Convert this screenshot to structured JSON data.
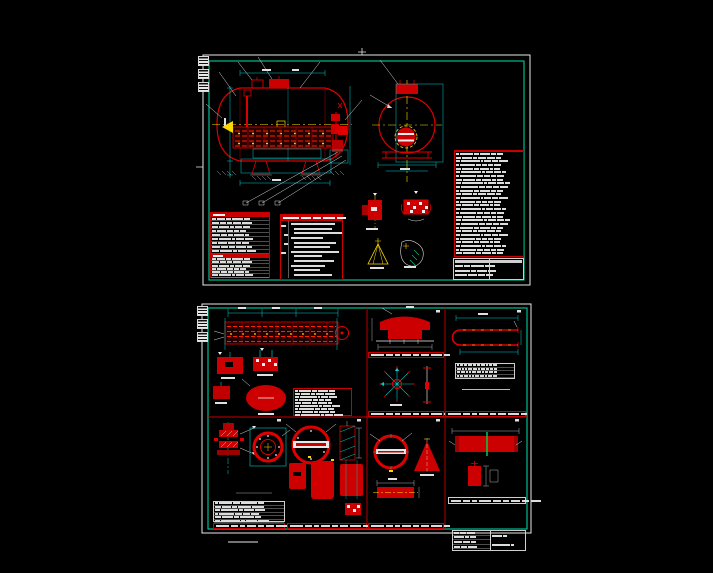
{
  "app": {
    "background": "#000000",
    "description_colors": {
      "frame_white": "#e8e8e8",
      "frame_teal": "#00dfae",
      "line_red": "#dd0000",
      "fill_red": "#cc0000",
      "dim_cyan": "#00cccc",
      "center_yellow": "#ffd700",
      "tick_green": "#00cc44",
      "text_white": "#dcdcdc"
    }
  },
  "sheets": {
    "top": {
      "tables": {
        "spec": {
          "rows_top": "9",
          "rows_bottom": "6",
          "cols": "14,20,12,18,16"
        },
        "notes": {
          "lines": "12",
          "widths": "44,38,48,32,42,36,48,28,40,34,26,38",
          "header": "16,10,8,12,9",
          "leftcol": "5,5,5,5"
        },
        "bom": {
          "rows": "28",
          "cols": "8,30,9,14,11,12"
        },
        "title": {
          "rows": "3",
          "cols": "24,14,22,14"
        }
      }
    },
    "bottom": {
      "tables": {
        "p1_bom": {
          "rows": "9",
          "cols": "10,32,10,18,16"
        },
        "p4_grid": {
          "rows": "4",
          "cols": "7,7,7,7,7,7,7,7,7,7"
        },
        "p5_parts": {
          "rows": "6",
          "cols": "9,28,11,22,16"
        },
        "p8_strip": {
          "widths": "10,7,5,12,8,6,9,7,10"
        },
        "p8_title_left": {
          "rows": "4",
          "cols": "30,22,28"
        },
        "p8_title_right": {
          "rows": "2",
          "cols": "60,20"
        }
      },
      "notes": {
        "p1": {
          "widths": "18,15,21,13,17"
        },
        "p4": {
          "widths": "44,26"
        },
        "p5": {
          "widths": "24,32"
        },
        "p6": {
          "widths": "38,34,40,28,36,18"
        },
        "p7": {
          "widths": "28,42,36,24"
        }
      },
      "strip_text": {
        "widths": "13,7,5,9,6,8,11,6"
      }
    }
  }
}
